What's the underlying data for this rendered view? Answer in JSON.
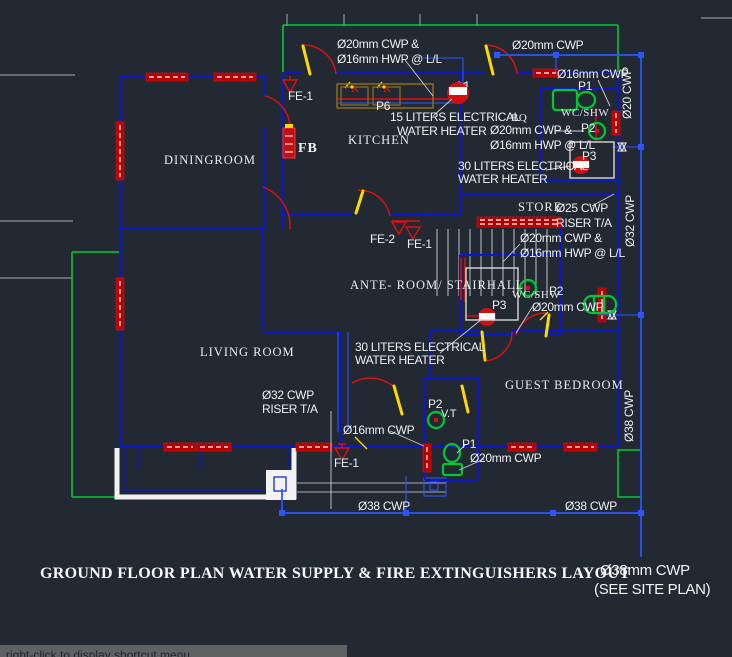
{
  "title": "GROUND FLOOR PLAN WATER SUPPLY & FIRE EXTINGUISHERS LAYOUT",
  "site_note": {
    "line1": "Ø38mm CWP",
    "line2": "(SEE SITE PLAN)"
  },
  "statusbar": {
    "hint": "right-click to display shortcut menu"
  },
  "rooms": {
    "dining": "DININGROOM",
    "kitchen": "KITCHEN",
    "ante_room": "ANTE- ROOM/ STAIRHALL",
    "living": "LIVING ROOM",
    "guest": "GUEST BEDROOM",
    "store": "STORE",
    "bq": "BQ",
    "wc_top": "WC/SHW",
    "wc_mid": "WC/SHW"
  },
  "labels": {
    "supply_top": {
      "line1": "Ø20mm CWP &",
      "line2": "Ø16mm HWP @ L/L"
    },
    "cwp20_top": "Ø20mm CWP",
    "cwp16_topright": "Ø16mm CWP",
    "heater15": {
      "line1": "15 LITERS ELECTRICAL",
      "line2": "WATER HEATER"
    },
    "bq_supply": {
      "line1": "Ø20mm CWP &",
      "line2": "Ø16mm HWP @ L/L"
    },
    "heater30_right": {
      "line1": "30 LITERS ELECTRICAL",
      "line2": "WATER HEATER"
    },
    "cwp25": {
      "line1": "Ø25 CWP",
      "line2": "RISER T/A"
    },
    "mid_supply": {
      "line1": "Ø20mm CWP &",
      "line2": "Ø16mm HWP @ L/L"
    },
    "cwp20_mid": "Ø20mm CWP",
    "heater30_mid": {
      "line1": "30 LITERS ELECTRICAL",
      "line2": "WATER HEATER"
    },
    "cwp32_riser": {
      "line1": "Ø32 CWP",
      "line2": "RISER T/A"
    },
    "cwp16_bottom": "Ø16mm CWP",
    "cwp20_bottom": "Ø20mm CWP",
    "cwp38_a": "Ø38 CWP",
    "cwp38_b": "Ø38 CWP",
    "v_cwp20": "Ø20 CWP",
    "v_cwp32": "Ø32 CWP",
    "v_cwp38": "Ø38 CWP"
  },
  "fixtures": {
    "fe1_top": "FE-1",
    "fe2": "FE-2",
    "fe1_mid": "FE-1",
    "fe1_bottom": "FE-1",
    "fb": "FB",
    "p6": "P6",
    "p1_top": "P1",
    "p2_top": "P2",
    "p3_top": "P3",
    "p3_mid": "P3",
    "p2_mid": "P2",
    "p1_bottom": "P1",
    "p2_bottom": "P2",
    "vt": "V.T"
  },
  "colors": {
    "background": "#222933",
    "wall_blue": "#0b16cf",
    "pipe_blue": "#2b55ff",
    "line_red": "#e01010",
    "hatch_red": "#b40000",
    "door_yellow": "#ffd900",
    "fixture_green": "#00c832",
    "terrace_green": "#00cc33",
    "text_white": "#eef0f2"
  }
}
